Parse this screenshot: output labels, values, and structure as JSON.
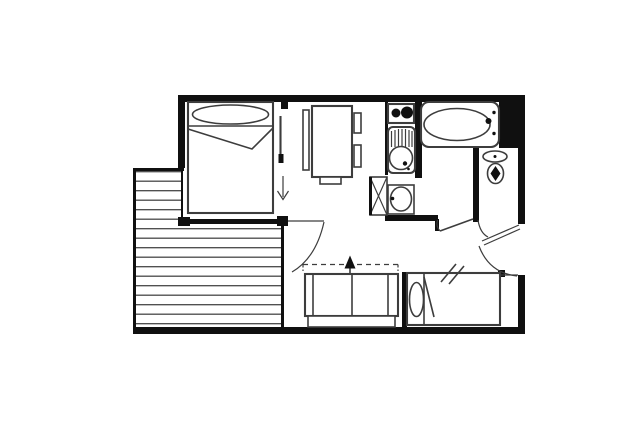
{
  "plan": {
    "kind": "studio-apartment-floor-plan",
    "visible_text": []
  },
  "colors": {
    "background": "#ffffff",
    "wall": "#101010",
    "line": "#3d3d3d",
    "hatch": "#474747"
  },
  "fixtures": {
    "double_bed": "double-bed",
    "bedroom_door": "bedroom-sliding-door",
    "dining_table": "dining-table",
    "chairs": "chairs",
    "kitchen_hob": "two-burner-hob",
    "kitchen_sink": "kitchen-sink-with-drainer",
    "utility_cabinet": "utility-cabinet",
    "bathtub": "bathtub",
    "washbasin": "washbasin",
    "toilet": "toilet",
    "entry_door": "entry-door",
    "shower_room_door": "shower-room-door",
    "sofa_bed": "convertible-sofa-bed",
    "fold_out_arrow": "fold-out-direction-arrow",
    "single_bed": "single-bed",
    "balcony": "balcony-with-decking",
    "balcony_door": "balcony-door",
    "passage_marks": "passage-marks"
  }
}
